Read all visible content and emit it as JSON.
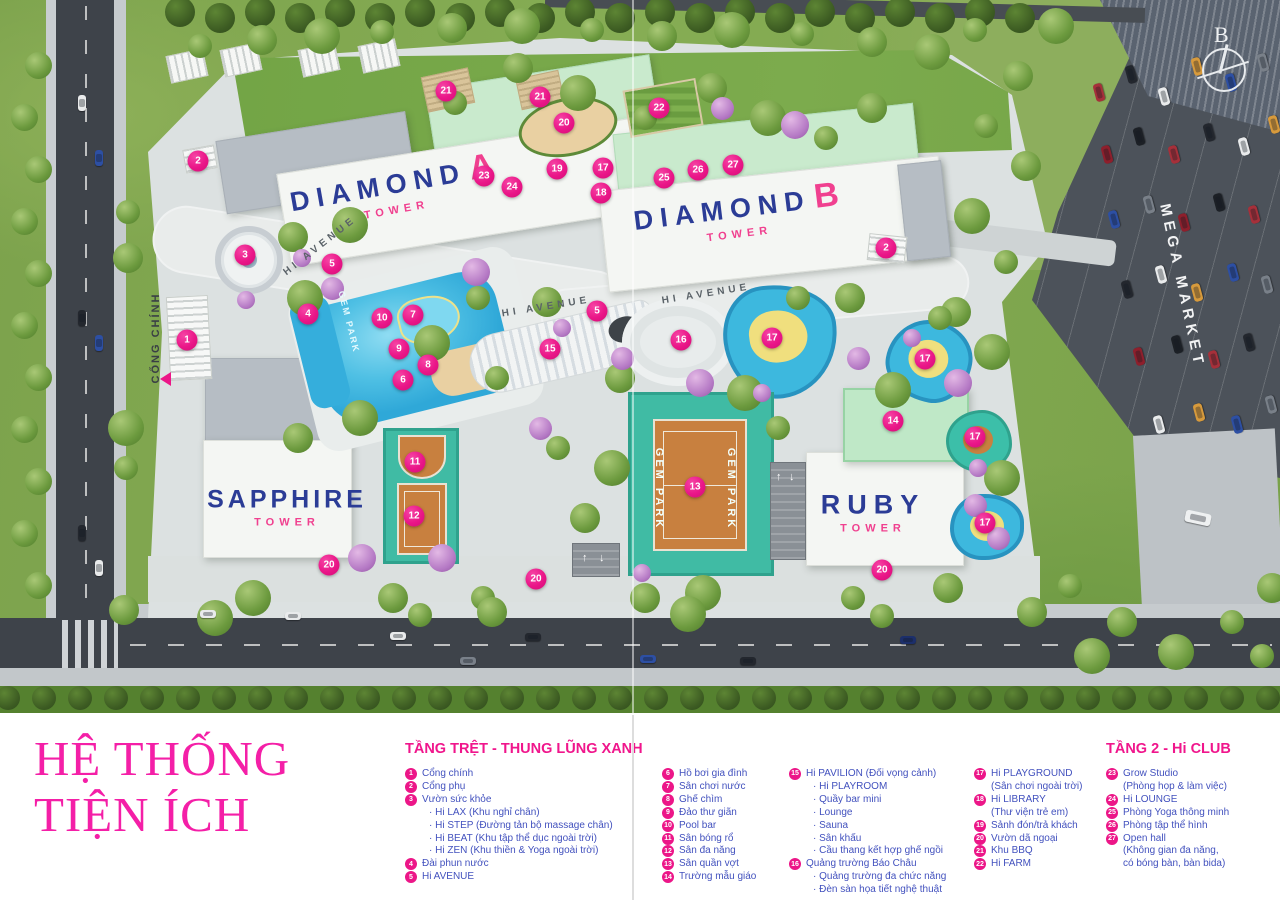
{
  "title_block": {
    "line1": "HỆ THỐNG",
    "line2": "TIỆN ÍCH"
  },
  "logo": {
    "letter": "B"
  },
  "icons": {
    "bullet": "·",
    "ramp_up_arrow": "↑",
    "ramp_down_arrow": "↓"
  },
  "colors": {
    "brand_pink": "#EC1688",
    "title_pink": "#F41FA7",
    "legend_blue": "#4251BE",
    "tower_blue": "#2B3C96",
    "tower_pink": "#F0408F"
  },
  "map": {
    "tower_labels": [
      {
        "id": "diamond-a",
        "name": "DIAMOND",
        "accent": "A",
        "sub": "TOWER",
        "x": 393,
        "y": 190,
        "rotate": -10,
        "small": false
      },
      {
        "id": "diamond-b",
        "name": "DIAMOND",
        "accent": "B",
        "sub": "TOWER",
        "x": 737,
        "y": 214,
        "rotate": -7,
        "small": false
      },
      {
        "id": "sapphire",
        "name": "SAPPHIRE",
        "accent": "",
        "sub": "TOWER",
        "x": 287,
        "y": 507,
        "rotate": 0,
        "small": true
      },
      {
        "id": "ruby",
        "name": "RUBY",
        "accent": "",
        "sub": "TOWER",
        "x": 873,
        "y": 512,
        "rotate": 0,
        "small": false
      }
    ],
    "street_labels": [
      {
        "id": "hi-avenue-1",
        "text": "HI AVENUE",
        "x": 320,
        "y": 246,
        "rotate": -38,
        "kind": "avenue"
      },
      {
        "id": "hi-avenue-2",
        "text": "HI AVENUE",
        "x": 546,
        "y": 307,
        "rotate": -9,
        "kind": "avenue"
      },
      {
        "id": "hi-avenue-3",
        "text": "HI AVENUE",
        "x": 706,
        "y": 294,
        "rotate": -9,
        "kind": "avenue"
      },
      {
        "id": "cong-chinh",
        "text": "CỔNG CHÍNH",
        "x": 156,
        "y": 338,
        "rotate": -90,
        "kind": "gate"
      },
      {
        "id": "mega-market",
        "text": "MEGA MARKET",
        "x": 1182,
        "y": 286,
        "rotate": 78,
        "kind": "mega"
      },
      {
        "id": "gem-park-pool",
        "text": "GEM PARK",
        "x": 349,
        "y": 322,
        "rotate": 76,
        "kind": "pool"
      },
      {
        "id": "gem-park-court-left",
        "text": "GEM PARK",
        "x": 659,
        "y": 489,
        "rotate": 90,
        "kind": "court"
      },
      {
        "id": "gem-park-court-right",
        "text": "GEM PARK",
        "x": 731,
        "y": 489,
        "rotate": 90,
        "kind": "court"
      }
    ],
    "markers": [
      {
        "n": "1",
        "x": 187,
        "y": 340
      },
      {
        "n": "2",
        "x": 198,
        "y": 161
      },
      {
        "n": "2",
        "x": 886,
        "y": 248
      },
      {
        "n": "3",
        "x": 245,
        "y": 255
      },
      {
        "n": "4",
        "x": 308,
        "y": 314
      },
      {
        "n": "5",
        "x": 332,
        "y": 264
      },
      {
        "n": "5",
        "x": 597,
        "y": 311
      },
      {
        "n": "6",
        "x": 403,
        "y": 380
      },
      {
        "n": "7",
        "x": 413,
        "y": 315
      },
      {
        "n": "8",
        "x": 428,
        "y": 365
      },
      {
        "n": "9",
        "x": 399,
        "y": 349
      },
      {
        "n": "10",
        "x": 382,
        "y": 318
      },
      {
        "n": "11",
        "x": 415,
        "y": 462
      },
      {
        "n": "12",
        "x": 414,
        "y": 516
      },
      {
        "n": "13",
        "x": 695,
        "y": 487
      },
      {
        "n": "14",
        "x": 893,
        "y": 421
      },
      {
        "n": "15",
        "x": 550,
        "y": 349
      },
      {
        "n": "16",
        "x": 681,
        "y": 340
      },
      {
        "n": "17",
        "x": 603,
        "y": 168
      },
      {
        "n": "17",
        "x": 772,
        "y": 338
      },
      {
        "n": "17",
        "x": 925,
        "y": 359
      },
      {
        "n": "17",
        "x": 975,
        "y": 437
      },
      {
        "n": "17",
        "x": 985,
        "y": 523
      },
      {
        "n": "18",
        "x": 601,
        "y": 193
      },
      {
        "n": "19",
        "x": 557,
        "y": 169
      },
      {
        "n": "20",
        "x": 564,
        "y": 123
      },
      {
        "n": "20",
        "x": 329,
        "y": 565
      },
      {
        "n": "20",
        "x": 536,
        "y": 579
      },
      {
        "n": "20",
        "x": 882,
        "y": 570
      },
      {
        "n": "21",
        "x": 446,
        "y": 91
      },
      {
        "n": "21",
        "x": 540,
        "y": 97
      },
      {
        "n": "22",
        "x": 659,
        "y": 108
      },
      {
        "n": "23",
        "x": 484,
        "y": 176
      },
      {
        "n": "24",
        "x": 512,
        "y": 187
      },
      {
        "n": "25",
        "x": 664,
        "y": 178
      },
      {
        "n": "26",
        "x": 698,
        "y": 170
      },
      {
        "n": "27",
        "x": 733,
        "y": 165
      }
    ]
  },
  "legend": {
    "columns": [
      {
        "header": "TẦNG TRỆT - THUNG LŨNG XANH",
        "items": [
          {
            "n": "1",
            "label": "Cổng chính"
          },
          {
            "n": "2",
            "label": "Cổng phụ"
          },
          {
            "n": "3",
            "label": "Vườn sức khỏe",
            "subs": [
              "Hi LAX (Khu nghỉ chân)",
              "Hi STEP (Đường tản bộ massage chân)",
              "Hi BEAT (Khu tập thể dục ngoài trời)",
              "Hi ZEN (Khu thiền & Yoga ngoài trời)"
            ]
          },
          {
            "n": "4",
            "label": "Đài phun nước"
          },
          {
            "n": "5",
            "label": "Hi AVENUE"
          }
        ]
      },
      {
        "header": null,
        "items": [
          {
            "n": "6",
            "label": "Hồ bơi gia đình"
          },
          {
            "n": "7",
            "label": "Sân chơi nước"
          },
          {
            "n": "8",
            "label": "Ghế chìm"
          },
          {
            "n": "9",
            "label": "Đảo thư giãn"
          },
          {
            "n": "10",
            "label": "Pool bar"
          },
          {
            "n": "11",
            "label": "Sân bóng rổ"
          },
          {
            "n": "12",
            "label": "Sân đa năng"
          },
          {
            "n": "13",
            "label": "Sân quần vợt"
          },
          {
            "n": "14",
            "label": "Trường mẫu giáo"
          }
        ]
      },
      {
        "header": null,
        "items": [
          {
            "n": "15",
            "label": "Hi PAVILION (Đối vọng cảnh)",
            "subs": [
              "Hi PLAYROOM",
              "Quầy bar mini",
              "Lounge",
              "Sauna",
              "Sân khấu",
              "Cầu thang kết hợp ghế ngồi"
            ]
          },
          {
            "n": "16",
            "label": "Quảng trường Báo Châu",
            "subs": [
              "Quảng trường đa chức năng",
              "Đèn sàn họa tiết nghệ thuật"
            ]
          }
        ]
      },
      {
        "header": null,
        "items": [
          {
            "n": "17",
            "label": "Hi PLAYGROUND",
            "notes": [
              "(Sân chơi ngoài trời)"
            ]
          },
          {
            "n": "18",
            "label": "Hi LIBRARY",
            "notes": [
              "(Thư viện trẻ em)"
            ]
          },
          {
            "n": "19",
            "label": "Sảnh đón/trả khách"
          },
          {
            "n": "20",
            "label": "Vườn dã ngoại"
          },
          {
            "n": "21",
            "label": "Khu BBQ"
          },
          {
            "n": "22",
            "label": "Hi FARM"
          }
        ]
      },
      {
        "header": "TẦNG 2 - Hi CLUB",
        "items": [
          {
            "n": "23",
            "label": "Grow Studio",
            "notes": [
              "(Phòng họp & làm việc)"
            ]
          },
          {
            "n": "24",
            "label": "Hi LOUNGE"
          },
          {
            "n": "25",
            "label": "Phòng Yoga thông minh"
          },
          {
            "n": "26",
            "label": "Phòng tập thể hình"
          },
          {
            "n": "27",
            "label": "Open hall",
            "notes": [
              "(Không gian đa năng,",
              "có bóng bàn, bàn bida)"
            ]
          }
        ]
      }
    ]
  }
}
